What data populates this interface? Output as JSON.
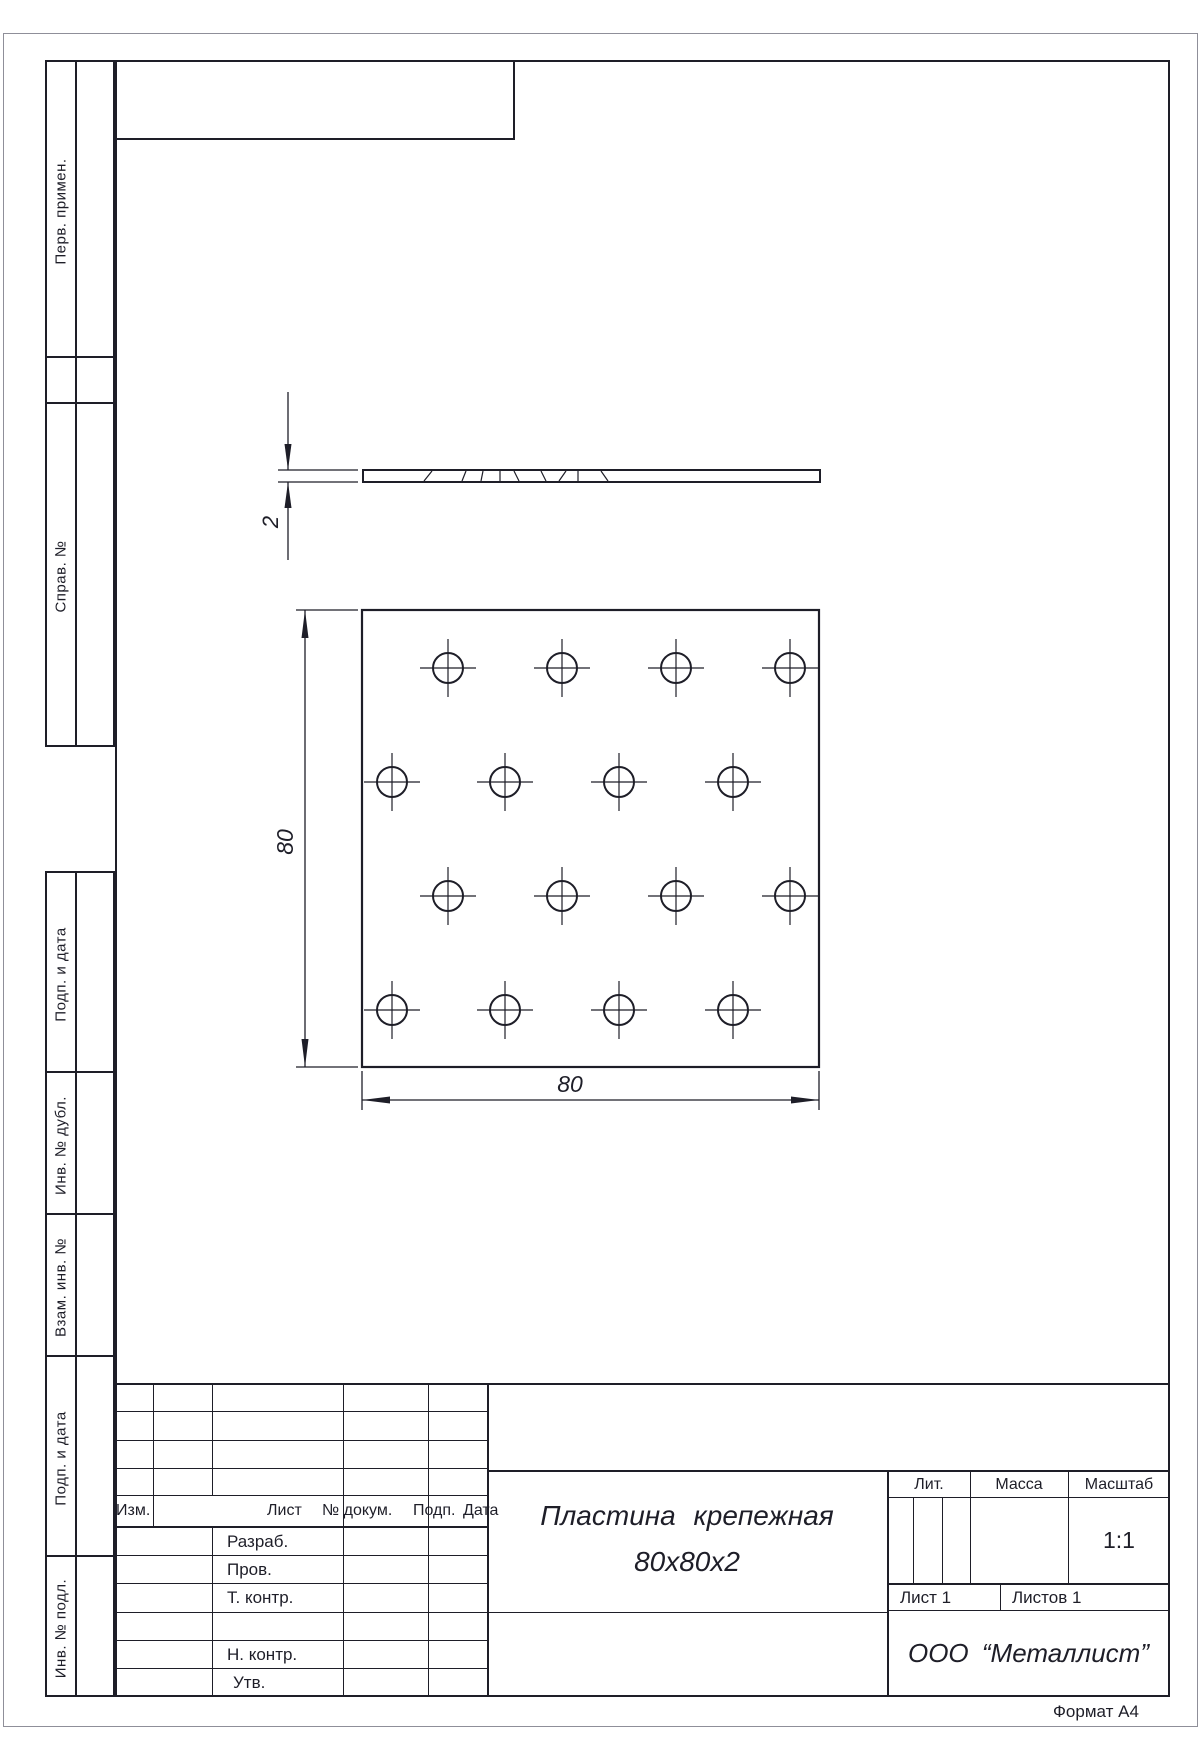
{
  "sheet": {
    "format_note": "Формат А4"
  },
  "margins": {
    "perv_primen": "Перв. примен.",
    "sprav_no": "Справ. №",
    "podp_data_1": "Подп. и дата",
    "inv_no_dubl": "Инв. № дубл.",
    "vzam_inv_no": "Взам. инв. №",
    "podp_data_2": "Подп. и дата",
    "inv_no_podl": "Инв. № подл."
  },
  "title_block": {
    "change_header": {
      "izm": "Изм.",
      "list": "Лист",
      "no_dokum": "№ докум.",
      "podp": "Подп.",
      "data": "Дата"
    },
    "roles": {
      "razrab": "Разраб.",
      "prov": "Пров.",
      "t_kontr": "Т. контр.",
      "n_kontr": "Н. контр.",
      "utv": "Утв."
    },
    "title_line1": "Пластина  крепежная",
    "title_line2": "80х80х2",
    "lit_label": "Лит.",
    "massa_label": "Масса",
    "masshtab_label": "Масштаб",
    "scale_value": "1:1",
    "sheet_no": "Лист 1",
    "sheets_total": "Листов 1",
    "company": "ООО  “Металлист”"
  },
  "drawing": {
    "dims": {
      "width": "80",
      "height": "80",
      "thickness": "2"
    },
    "plate": {
      "x": 362,
      "y": 610,
      "size": 457
    },
    "hole_radius": 15,
    "crosshair": {
      "v": 29,
      "h": 28
    },
    "holes": [
      {
        "cx": 448,
        "cy": 668
      },
      {
        "cx": 562,
        "cy": 668
      },
      {
        "cx": 676,
        "cy": 668
      },
      {
        "cx": 790,
        "cy": 668
      },
      {
        "cx": 392,
        "cy": 782
      },
      {
        "cx": 505,
        "cy": 782
      },
      {
        "cx": 619,
        "cy": 782
      },
      {
        "cx": 733,
        "cy": 782
      },
      {
        "cx": 448,
        "cy": 896
      },
      {
        "cx": 562,
        "cy": 896
      },
      {
        "cx": 676,
        "cy": 896
      },
      {
        "cx": 790,
        "cy": 896
      },
      {
        "cx": 392,
        "cy": 1010
      },
      {
        "cx": 505,
        "cy": 1010
      },
      {
        "cx": 619,
        "cy": 1010
      },
      {
        "cx": 733,
        "cy": 1010
      }
    ],
    "edge_view": {
      "x": 363,
      "y": 470,
      "w": 457,
      "h": 12
    },
    "edge_ticks": [
      [
        432,
        424
      ],
      [
        466,
        462
      ],
      [
        483,
        481
      ],
      [
        500,
        500
      ],
      [
        514,
        519
      ],
      [
        541,
        546
      ],
      [
        566,
        559
      ],
      [
        578,
        578
      ],
      [
        601,
        608
      ]
    ]
  }
}
